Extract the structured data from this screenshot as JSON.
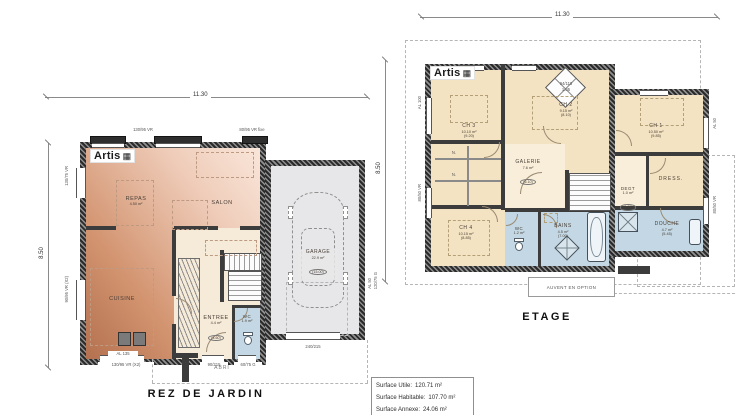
{
  "brand": {
    "name": "Artis",
    "icon": "▦"
  },
  "ground_floor": {
    "title": "REZ DE JARDIN",
    "dim_width": "11.30",
    "dim_height": "8.50",
    "rooms": {
      "repas": {
        "name": "REPAS",
        "area": "4.50 m²"
      },
      "salon": {
        "name": "SALON"
      },
      "cuisine": {
        "name": "CUISINE"
      },
      "entree": {
        "name": "ENTREE",
        "area": "4.4 m²",
        "area_net": "(4.60)"
      },
      "wc": {
        "name": "WC",
        "area": "1.9 m²"
      },
      "garage": {
        "name": "GARAGE",
        "area": "22.9 m²",
        "area_net": "(15.00)"
      },
      "abri": {
        "name": "ABRI"
      }
    },
    "openings": {
      "win_top_left": "130/95 VR",
      "win_top_right": "80/95 VR fixe",
      "win_left_upper": "130/75 VR",
      "win_left_lower": "90/95 VR (X2)",
      "bay_bottom": "AL 135",
      "win_bottom": "130/95 VR (X2)",
      "door_entry": "90/215",
      "win_wc": "60/75 G",
      "garage_side_upper": "AL 50",
      "garage_side_lower": "120/75 G",
      "garage_door": "240/215"
    }
  },
  "upper_floor": {
    "title": "ETAGE",
    "dim_width": "11.30",
    "dim_height": "8.50",
    "note": "AUVENT EN OPTION",
    "velux": {
      "size": "94/118",
      "ref": "1.05"
    },
    "rooms": {
      "ch1": {
        "name": "CH 1",
        "area": "10.50 m²",
        "area_net": "(9.85)"
      },
      "ch2": {
        "name": "CH 2",
        "area": "9.15 m²",
        "area_net": "(8.10)"
      },
      "ch3": {
        "name": "CH 3",
        "area": "10.10 m²",
        "area_net": "(9.20)"
      },
      "ch4": {
        "name": "CH 4",
        "area": "10.15 m²",
        "area_net": "(8.85)"
      },
      "galerie": {
        "name": "GALERIE",
        "area": "7.6 m²",
        "area_net": "(6.10)"
      },
      "dress": {
        "name": "DRESS."
      },
      "degt": {
        "name": "DEGT",
        "area": "1.0 m²",
        "area_net": "(1.35)"
      },
      "wc": {
        "name": "WC",
        "area": "1.2 m²"
      },
      "bains": {
        "name": "BAINS",
        "area": "4.5 m²",
        "area_net": "(7.00)"
      },
      "douche": {
        "name": "DOUCHE",
        "area": "4.7 m²",
        "area_net": "(5.45)"
      }
    },
    "closet_marks": {
      "n1": "N.",
      "n2": "N."
    },
    "openings": {
      "win_left_upper": "AL 100",
      "win_left_lower": "80/50 VR",
      "win_right_upper": "AL 50",
      "win_right_lower": "80/50 VR"
    }
  },
  "surface_box": {
    "lines": [
      {
        "label": "Surface Utile:",
        "value": "120.71 m²"
      },
      {
        "label": "Surface Habitable:",
        "value": "107.70 m²"
      },
      {
        "label": "Surface  Annexe:",
        "value": "24.06 m²"
      }
    ]
  },
  "colors": {
    "living_dark": "#b4714f",
    "living_light": "#f9e6da",
    "hall_cream": "#f6ead8",
    "wet_blue": "#c3d8e4",
    "bedroom_cream": "#f4e3c2",
    "galerie_cream": "#f8eed9",
    "garage_grey": "#e7e7e9",
    "wall": "#3c3c3c"
  }
}
